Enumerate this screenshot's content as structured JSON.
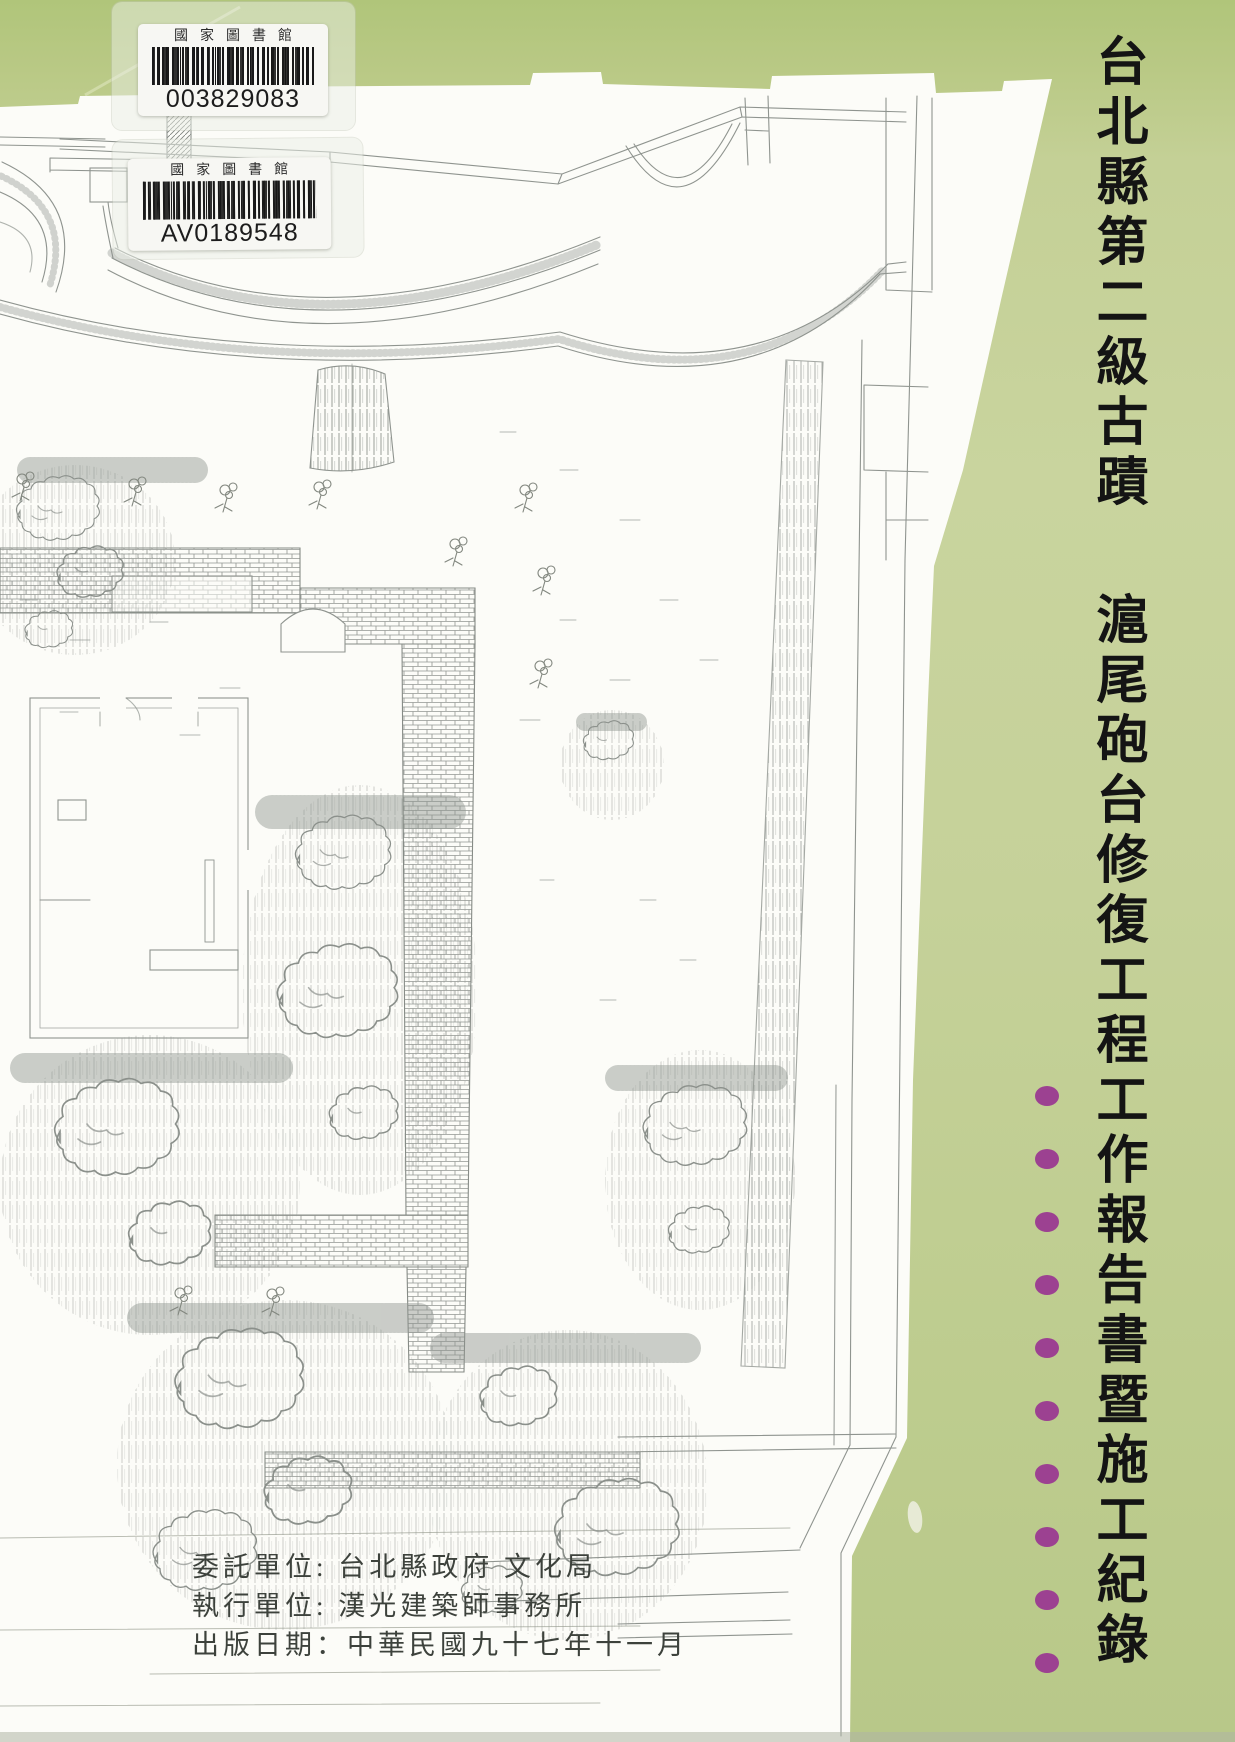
{
  "cover": {
    "classification": "台北縣第二級古蹟",
    "title": "滬尾砲台修復工程工作報告書暨施工紀錄",
    "credits": [
      "委託單位: 台北縣政府 文化局",
      "執行單位: 漢光建築師事務所",
      "出版日期：中華民國九十七年十一月"
    ],
    "dot_count": 10,
    "accent_dot_color": "#9c4191",
    "cover_green": "#c0cd92",
    "title_color": "#141414"
  },
  "library_labels": [
    {
      "institution": "國家圖書館",
      "code": "003829083"
    },
    {
      "institution": "國家圖書館",
      "code": "AV0189548"
    }
  ]
}
